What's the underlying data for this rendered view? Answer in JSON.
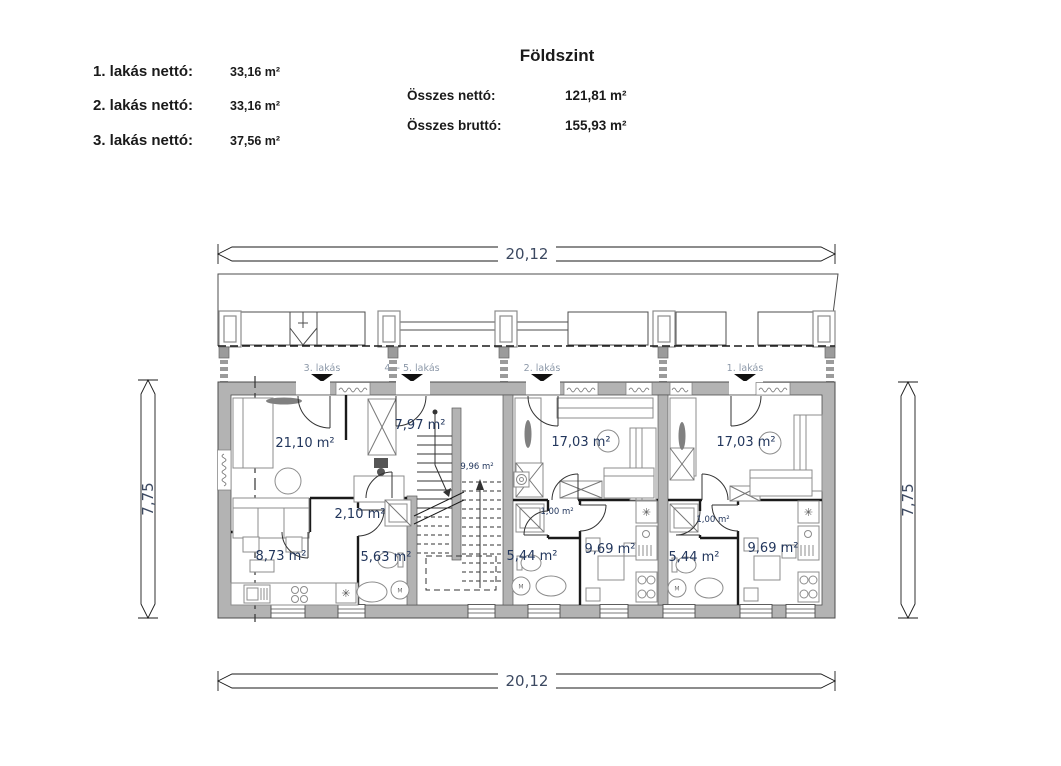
{
  "header": {
    "title": "Földszint",
    "net_areas": [
      {
        "label": "1. lakás nettó:",
        "value": "33,16 m²"
      },
      {
        "label": "2. lakás nettó:",
        "value": "33,16 m²"
      },
      {
        "label": "3. lakás nettó:",
        "value": "37,56 m²"
      }
    ],
    "totals": [
      {
        "label": "Összes nettó:",
        "value": "121,81 m²"
      },
      {
        "label": "Összes bruttó:",
        "value": "155,93 m²"
      }
    ]
  },
  "dimensions": {
    "width_top": "20,12",
    "width_bottom": "20,12",
    "height_left": "7,75",
    "height_right": "7,75"
  },
  "plan": {
    "unit_labels": {
      "u3": "3. lakás",
      "u45": "4. - 5. lakás",
      "u2": "2. lakás",
      "u1": "1. lakás"
    },
    "rooms": {
      "living3": "21,10 m²",
      "entry3": "7,97 m²",
      "stair": "9,96 m²",
      "hall3": "2,10 m²",
      "room3": "8,73 m²",
      "bath3": "5,63 m²",
      "living2": "17,03 m²",
      "hall2": "1,00 m²",
      "bath2": "5,44 m²",
      "room2": "9,69 m²",
      "living1": "17,03 m²",
      "hall1": "1,00 m²",
      "bath1": "5,44 m²",
      "room1": "9,69 m²"
    },
    "fixtures": {
      "washer": "M",
      "boiler": "✳"
    }
  },
  "colors": {
    "wall": "#b3b3b3",
    "line": "#4d4d4d",
    "room_label": "#22365c",
    "unit_label": "#8d99a9",
    "dim_text": "#3c4961"
  }
}
